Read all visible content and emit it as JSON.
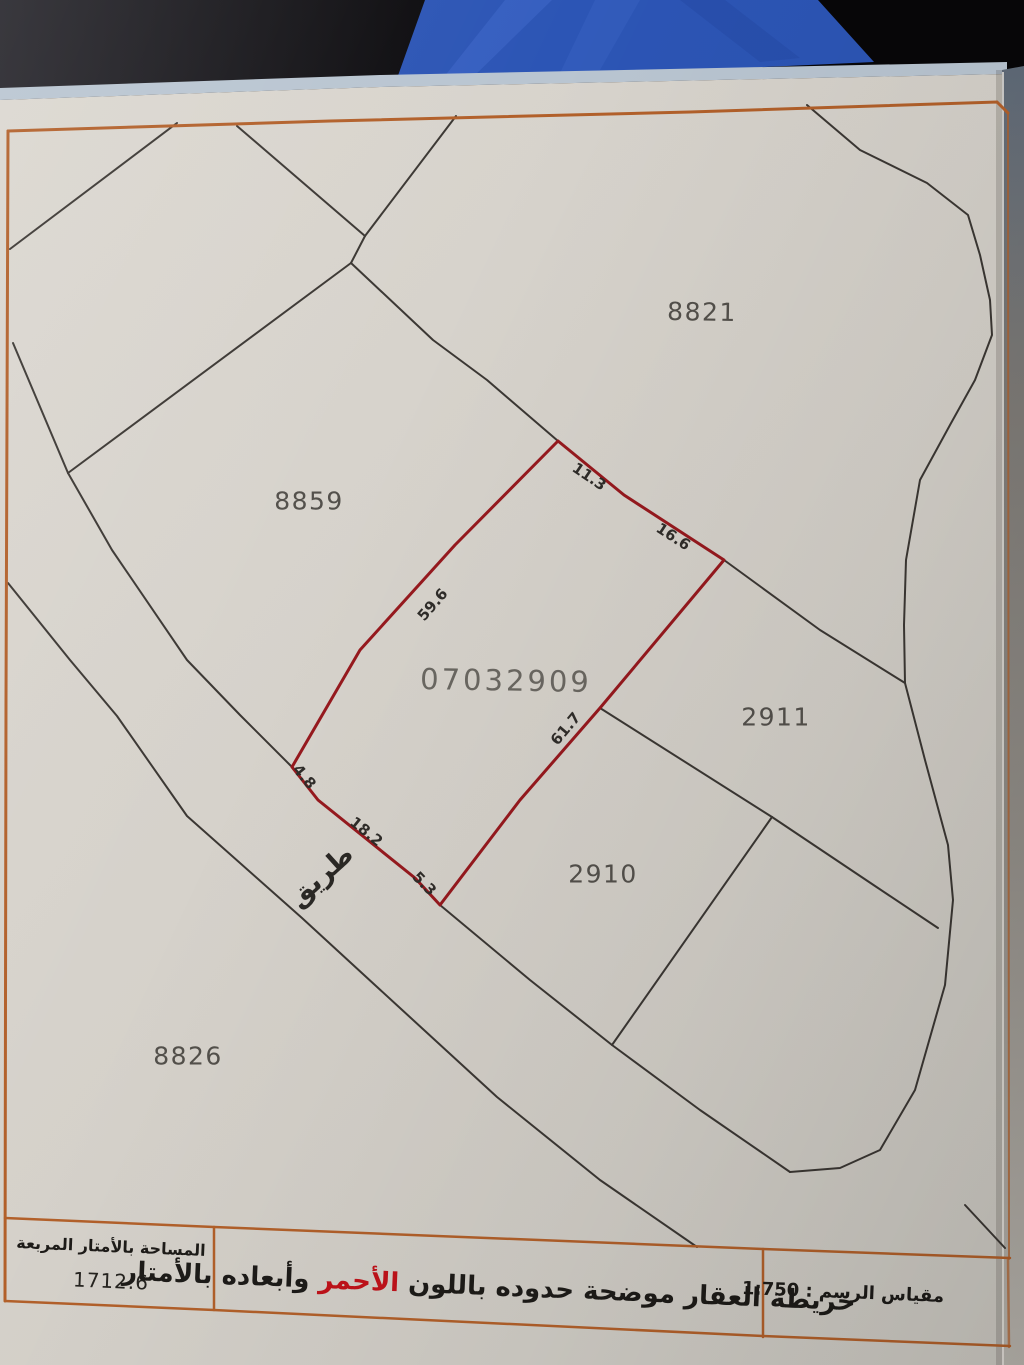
{
  "map": {
    "parcels": {
      "p8821": "8821",
      "p8859": "8859",
      "p2911": "2911",
      "p2910": "2910",
      "p8826": "8826"
    },
    "subject": {
      "number": "07032909"
    },
    "dimensions": {
      "top_left": "11.3",
      "top_right": "16.6",
      "west": "59.6",
      "east": "61.7",
      "road_a": "4.8",
      "road_b": "18.2",
      "road_c": "5.3"
    },
    "road_label": "طريق"
  },
  "footer": {
    "area": {
      "label": "المساحة بالأمتار المربعة",
      "value": "1712.6"
    },
    "note": {
      "before": "خريطة العقار موضحة حدوده باللون ",
      "red_word": "الأحمر",
      "after": " وأبعاده بالأمتار"
    },
    "scale": {
      "label": "مقياس الرسم :",
      "value": "1:750"
    }
  },
  "colors": {
    "subject_boundary_red": "#96191e",
    "border_orange": "#b2602a",
    "red_text": "#c1121a",
    "paper": "#d5d1ca",
    "background_blue": "#2c55b5",
    "plot_line_black": "#3b3733"
  }
}
